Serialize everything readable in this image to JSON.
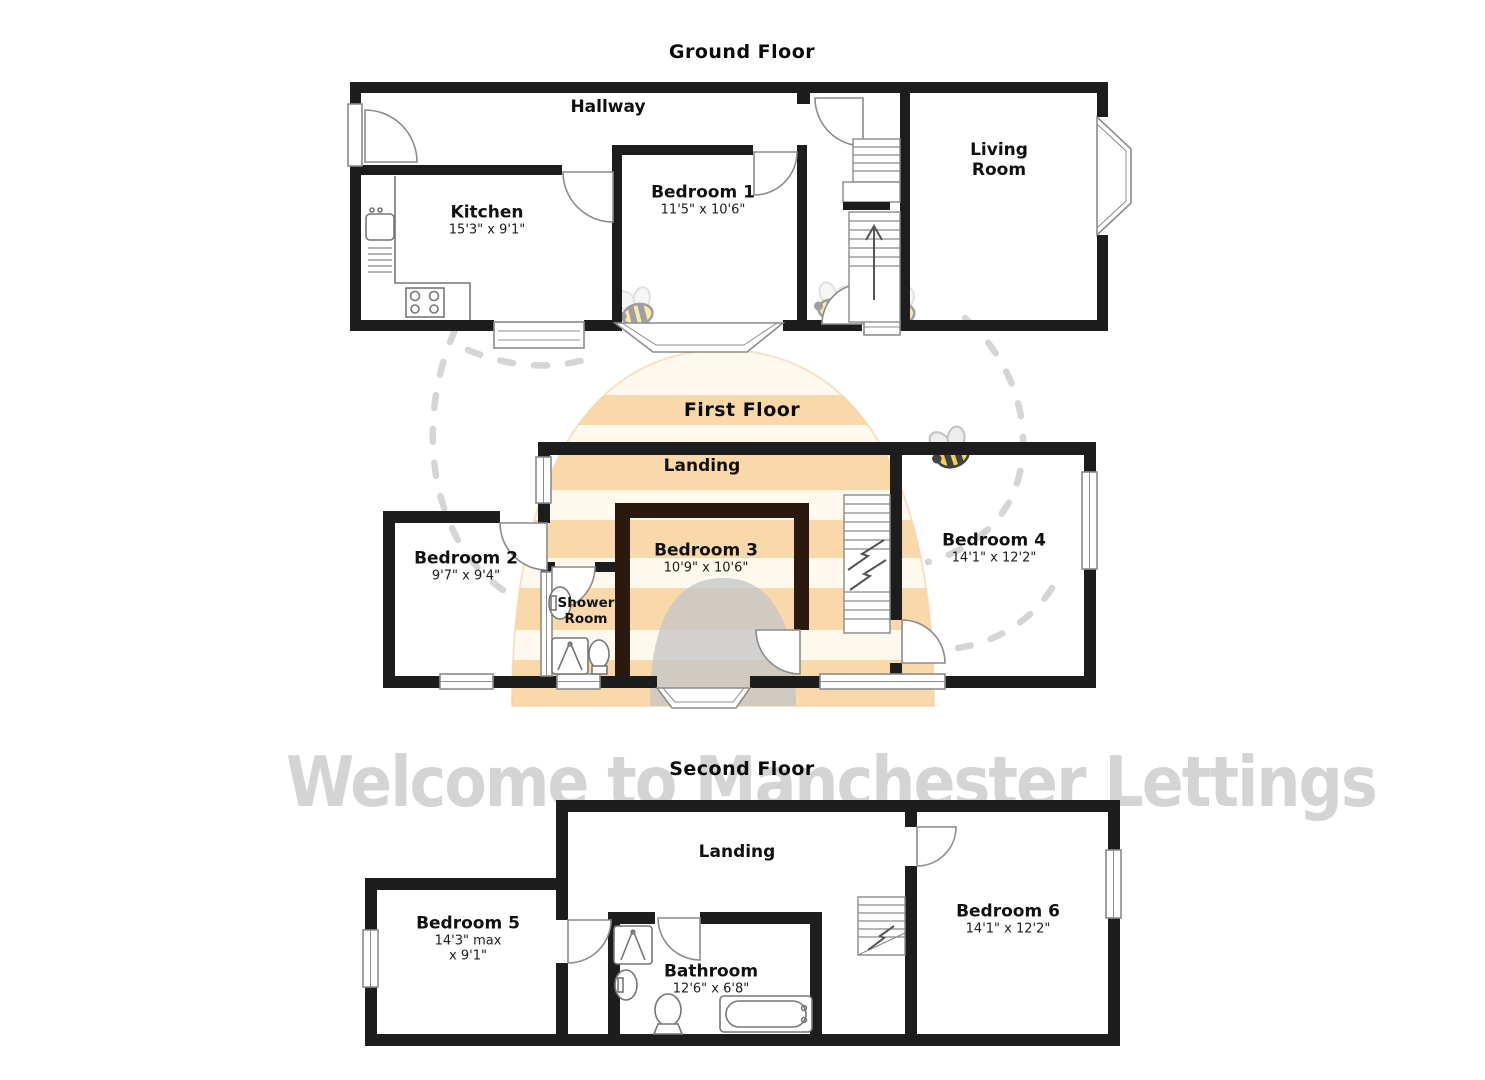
{
  "watermark": {
    "text": "Welcome to Manchester Lettings",
    "text_color": "#d4d4d4",
    "hive_cream": "#fcefd2",
    "hive_orange": "#f2a63e",
    "hive_door_gray": "#8f8f8f",
    "bee_yellow": "#f5cf49",
    "trail_gray": "#cbcbcb"
  },
  "plan_colors": {
    "wall": "#1d1d1d",
    "bedroom3_inner_wall": "#2a190c"
  },
  "floors": {
    "ground": {
      "title": "Ground Floor",
      "rooms": {
        "hallway": {
          "name": "Hallway"
        },
        "kitchen": {
          "name": "Kitchen",
          "dims": "15'3\" x 9'1\""
        },
        "bedroom1": {
          "name": "Bedroom 1",
          "dims": "11'5\" x 10'6\""
        },
        "living_room": {
          "line1": "Living",
          "line2": "Room"
        }
      }
    },
    "first": {
      "title": "First Floor",
      "rooms": {
        "landing": {
          "name": "Landing"
        },
        "bedroom2": {
          "name": "Bedroom 2",
          "dims": "9'7\" x 9'4\""
        },
        "bedroom3": {
          "name": "Bedroom 3",
          "dims": "10'9\" x 10'6\""
        },
        "bedroom4": {
          "name": "Bedroom 4",
          "dims": "14'1\" x 12'2\""
        },
        "shower_room": {
          "line1": "Shower",
          "line2": "Room"
        }
      }
    },
    "second": {
      "title": "Second Floor",
      "rooms": {
        "landing": {
          "name": "Landing"
        },
        "bedroom5": {
          "name": "Bedroom 5",
          "dims_line1": "14'3\" max",
          "dims_line2": "x 9'1\""
        },
        "bathroom": {
          "name": "Bathroom",
          "dims": "12'6\" x 6'8\""
        },
        "bedroom6": {
          "name": "Bedroom 6",
          "dims": "14'1\" x 12'2\""
        }
      }
    }
  }
}
